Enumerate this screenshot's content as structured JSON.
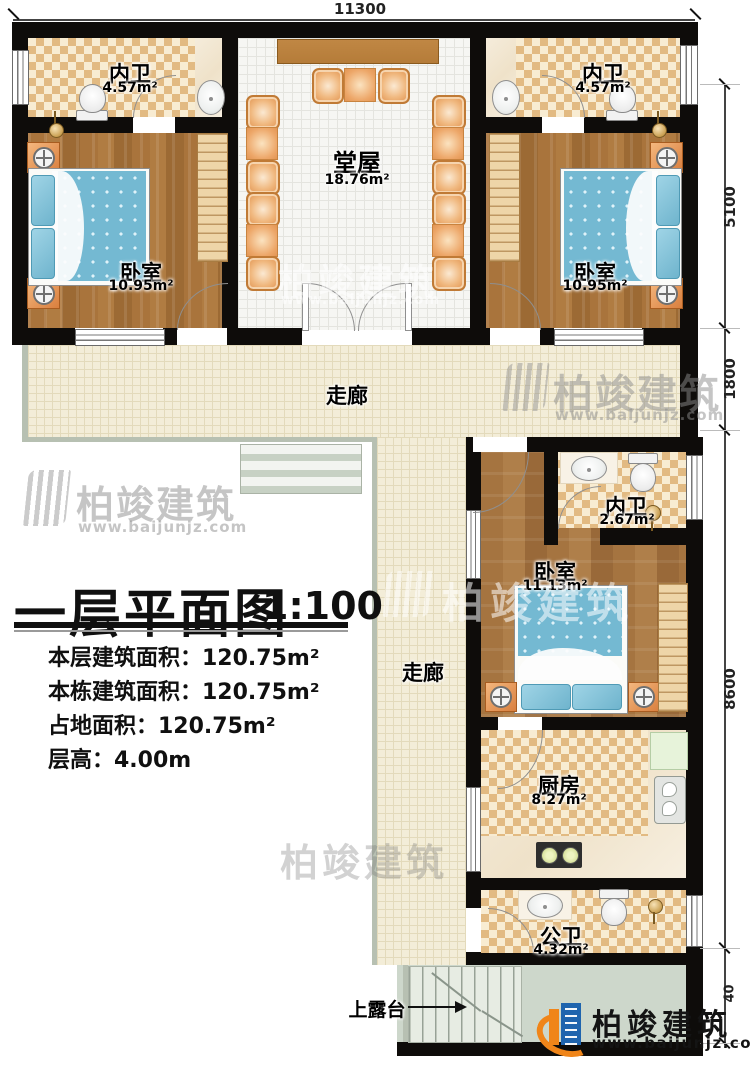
{
  "dimensions": {
    "top": "11300",
    "right_segments": [
      "5100",
      "1800",
      "8600",
      "40"
    ]
  },
  "rooms": {
    "bath_top_left": {
      "name": "内卫",
      "area": "4.57m²"
    },
    "bath_top_right": {
      "name": "内卫",
      "area": "4.57m²"
    },
    "hall": {
      "name": "堂屋",
      "area": "18.76m²"
    },
    "bed_top_left": {
      "name": "卧室",
      "area": "10.95m²"
    },
    "bed_top_right": {
      "name": "卧室",
      "area": "10.95m²"
    },
    "corridor_h": {
      "name": "走廊"
    },
    "corridor_v": {
      "name": "走廊"
    },
    "bath_mid": {
      "name": "内卫",
      "area": "2.67m²"
    },
    "bed_lower": {
      "name": "卧室",
      "area": "11.13m²"
    },
    "kitchen": {
      "name": "厨房",
      "area": "8.27m²"
    },
    "bath_public": {
      "name": "公卫",
      "area": "4.32m²"
    },
    "terrace": {
      "name": "上露台"
    }
  },
  "title_block": {
    "title": "一层平面图",
    "scale": "1:100",
    "info_lines": [
      "本层建筑面积：120.75m²",
      "本栋建筑面积：120.75m²",
      "占地面积：120.75m²",
      "层高：4.00m"
    ]
  },
  "branding": {
    "name": "柏竣建筑",
    "website": "www.baijunjz.com"
  },
  "colors": {
    "wall": "#0e0c0a",
    "wood": "#a9743c",
    "tile_checker": "#e2ba82",
    "bed": "#74b9d2",
    "furniture_orange": "#e0924f",
    "logo_blue": "#1f64ae",
    "logo_orange": "#f08519"
  }
}
